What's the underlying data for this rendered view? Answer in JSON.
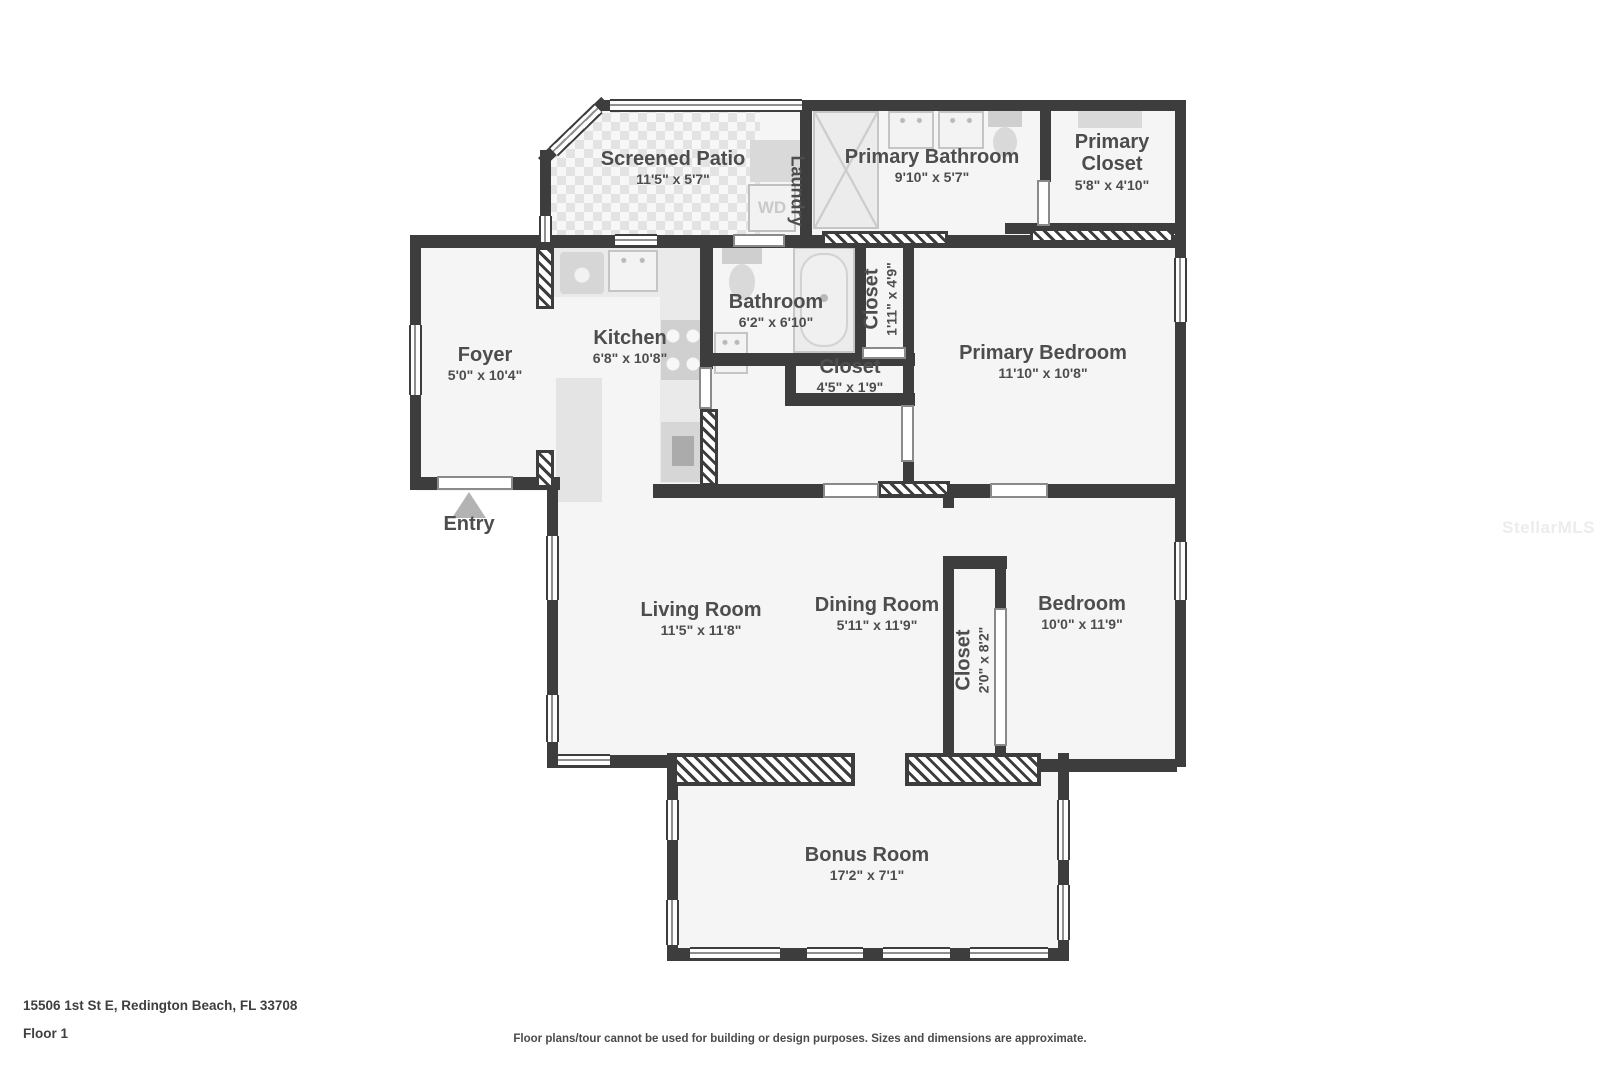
{
  "page": {
    "address": "15506 1st St E, Redington Beach, FL 33708",
    "floor": "Floor 1",
    "disclaimer": "Floor plans/tour cannot be used for building or design purposes. Sizes and dimensions are approximate.",
    "watermark": "StellarMLS"
  },
  "plan": {
    "entry": "Entry",
    "laundry": "Laundry",
    "washer_dryer": "WD"
  },
  "colors": {
    "wall": "#3d3d3d",
    "room_fill": "#f5f5f5",
    "label_text": "#4d4d4d",
    "fixture": "#d6d6d6"
  },
  "rooms": {
    "screened_patio": {
      "name": "Screened Patio",
      "dims": "11'5\" x 5'7\""
    },
    "primary_bathroom": {
      "name": "Primary Bathroom",
      "dims": "9'10\" x 5'7\""
    },
    "primary_closet": {
      "name": "Primary Closet",
      "dims": "5'8\" x 4'10\""
    },
    "foyer": {
      "name": "Foyer",
      "dims": "5'0\" x 10'4\""
    },
    "kitchen": {
      "name": "Kitchen",
      "dims": "6'8\" x 10'8\""
    },
    "bathroom": {
      "name": "Bathroom",
      "dims": "6'2\" x 6'10\""
    },
    "closet_hall": {
      "name": "Closet",
      "dims": "1'11\" x 4'9\""
    },
    "closet_small": {
      "name": "Closet",
      "dims": "4'5\" x 1'9\""
    },
    "primary_bedroom": {
      "name": "Primary Bedroom",
      "dims": "11'10\" x 10'8\""
    },
    "living_room": {
      "name": "Living Room",
      "dims": "11'5\" x 11'8\""
    },
    "dining_room": {
      "name": "Dining Room",
      "dims": "5'11\" x 11'9\""
    },
    "closet_bedroom": {
      "name": "Closet",
      "dims": "2'0\" x 8'2\""
    },
    "bedroom": {
      "name": "Bedroom",
      "dims": "10'0\" x 11'9\""
    },
    "bonus_room": {
      "name": "Bonus Room",
      "dims": "17'2\" x 7'1\""
    }
  }
}
